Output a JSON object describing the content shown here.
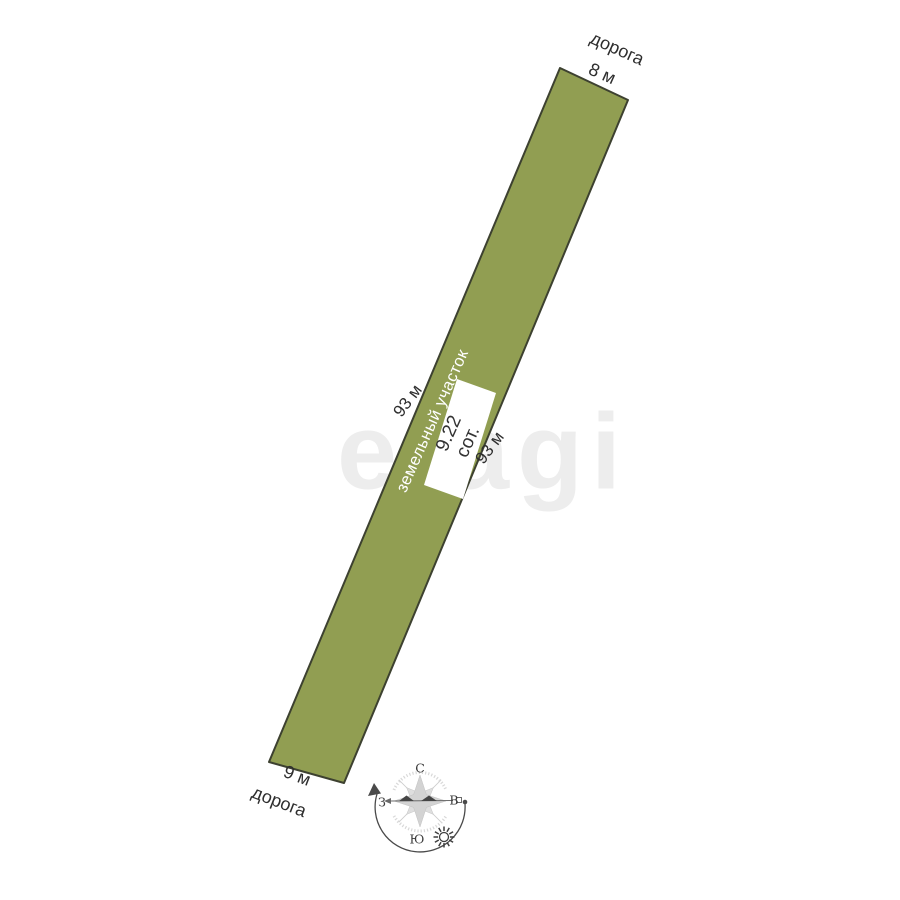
{
  "watermark": {
    "text": "etagi",
    "color": "#ededed"
  },
  "plot": {
    "fill_color": "#919e52",
    "border_color": "#3d4130",
    "name_label": "земельный участок",
    "area_value": "9.22",
    "area_unit": "сот.",
    "left_side_length": "93 м",
    "right_side_length": "93 м",
    "top_width": "8 м",
    "bottom_width": "9 м",
    "top_road_label": "дорога",
    "bottom_road_label": "дорога"
  },
  "compass": {
    "north": "С",
    "south": "Ю",
    "west": "З",
    "east": "В"
  }
}
